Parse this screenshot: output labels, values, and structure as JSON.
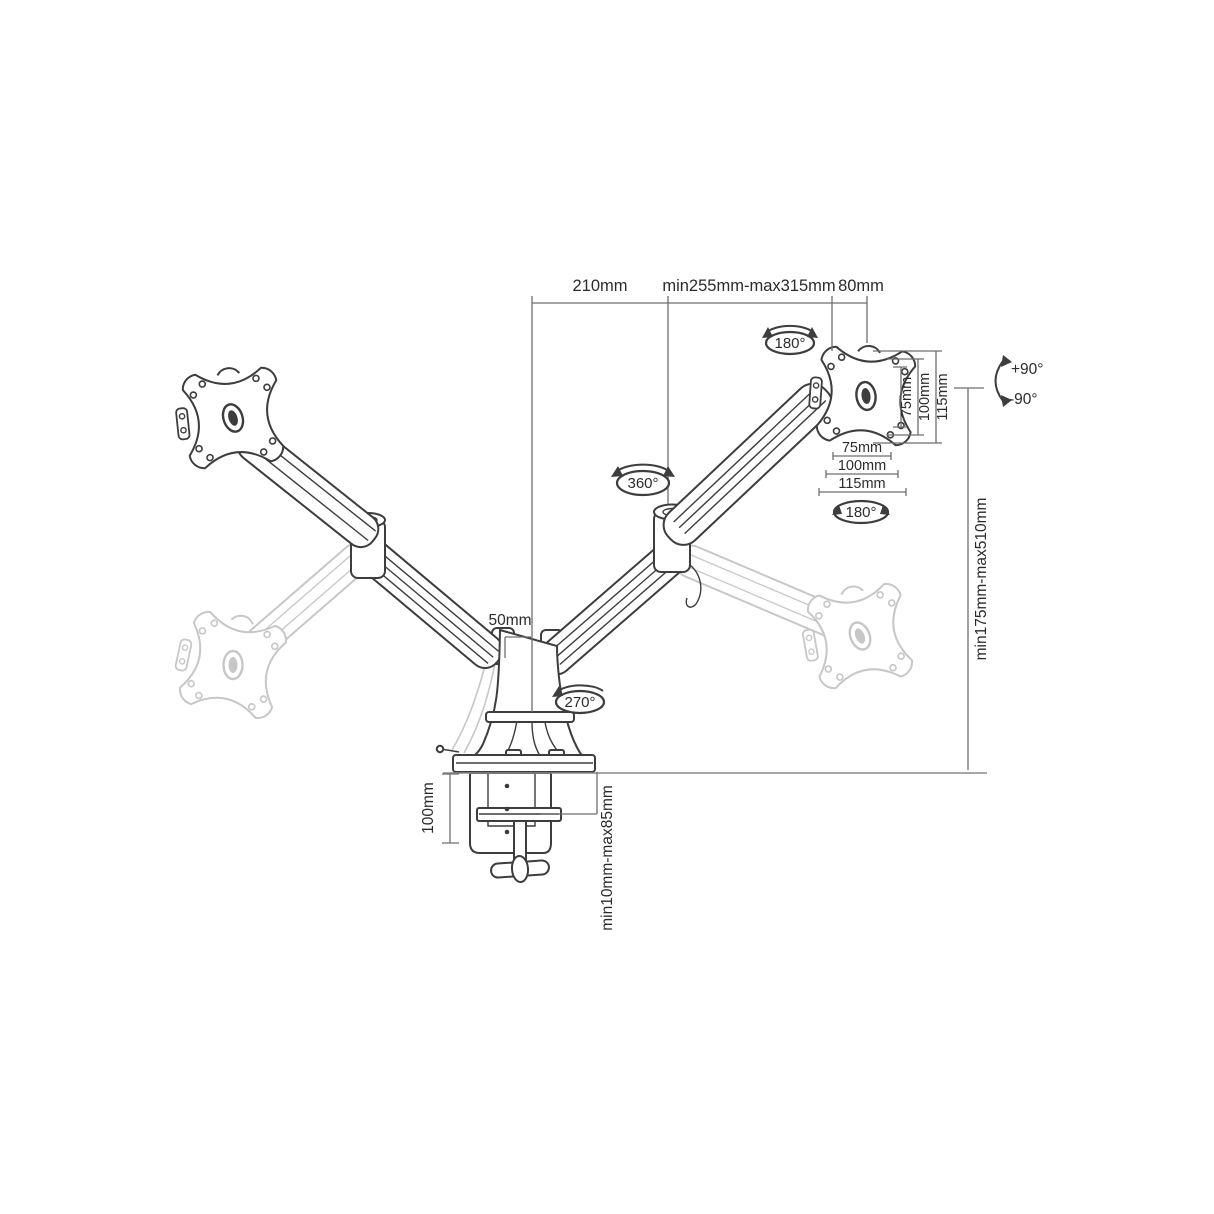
{
  "figure": {
    "type": "technical-dimension-diagram",
    "subject": "dual gas-spring monitor desk mount arm",
    "labels": {
      "dim_arm1": "210mm",
      "dim_arm2": "min255mm-max315mm",
      "dim_head": "80mm",
      "dim_height": "min175mm-max510mm",
      "dim_pole": "50mm",
      "dim_clamp_depth": "100mm",
      "dim_clamp_range": "min10mm-max85mm",
      "tilt_plus": "+90°",
      "tilt_minus": "-90°",
      "rot_head_top": "180°",
      "rot_head_side": "180°",
      "rot_elbow": "360°",
      "rot_base": "270°",
      "vesa_side": [
        "75mm",
        "100mm",
        "115mm"
      ],
      "vesa_bottom": [
        "75mm",
        "100mm",
        "115mm"
      ]
    },
    "colors": {
      "structure": "#3d3d3d",
      "dimension_lines": "#6e6e6e",
      "ghost": "#c7c7c7",
      "text": "#2b2b2b",
      "background": "#ffffff"
    }
  }
}
